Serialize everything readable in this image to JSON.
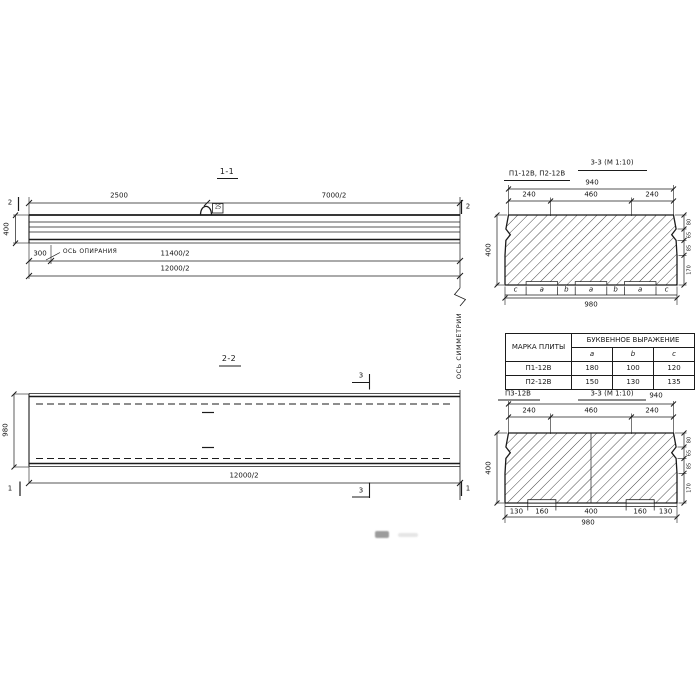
{
  "sec11": {
    "title": "1-1",
    "d2500": "2500",
    "d7000": "7000/2",
    "d400": "400",
    "d300": "300",
    "d11400": "11400/2",
    "d12000": "12000/2",
    "support": "ОСЬ ОПИРАНИЯ",
    "cut2l": "2",
    "cut2r": "2",
    "looptag": "25"
  },
  "sym": {
    "label": "ОСЬ СИММЕТРИИ"
  },
  "sec22": {
    "title": "2-2",
    "d980": "980",
    "d12000": "12000/2",
    "cut1l": "1",
    "cut1r": "1",
    "cut3t": "3",
    "cut3b": "3"
  },
  "sec33a": {
    "label": "П1-12В, П2-12В",
    "title": "3-3 (М 1:10)",
    "d940": "940",
    "top": [
      "240",
      "460",
      "240"
    ],
    "d400": "400",
    "right": [
      "80",
      "65",
      "85",
      "170"
    ],
    "letters": [
      "c",
      "a",
      "b",
      "a",
      "b",
      "a",
      "c"
    ],
    "d980": "980"
  },
  "table": {
    "h_mark": "МАРКА ПЛИТЫ",
    "h_expr": "БУКВЕННОЕ ВЫРАЖЕНИЕ",
    "cols": [
      "a",
      "b",
      "c"
    ],
    "rows": [
      {
        "mark": "П1-12В",
        "a": "180",
        "b": "100",
        "c": "120"
      },
      {
        "mark": "П2-12В",
        "a": "150",
        "b": "130",
        "c": "135"
      }
    ]
  },
  "sec33b": {
    "label": "П3-12В",
    "title": "3-3 (М 1:10)",
    "d940": "940",
    "top": [
      "240",
      "460",
      "240"
    ],
    "d400": "400",
    "right": [
      "80",
      "65",
      "85",
      "170"
    ],
    "bottom": [
      "130",
      "160",
      "400",
      "160",
      "130"
    ],
    "d980": "980"
  }
}
